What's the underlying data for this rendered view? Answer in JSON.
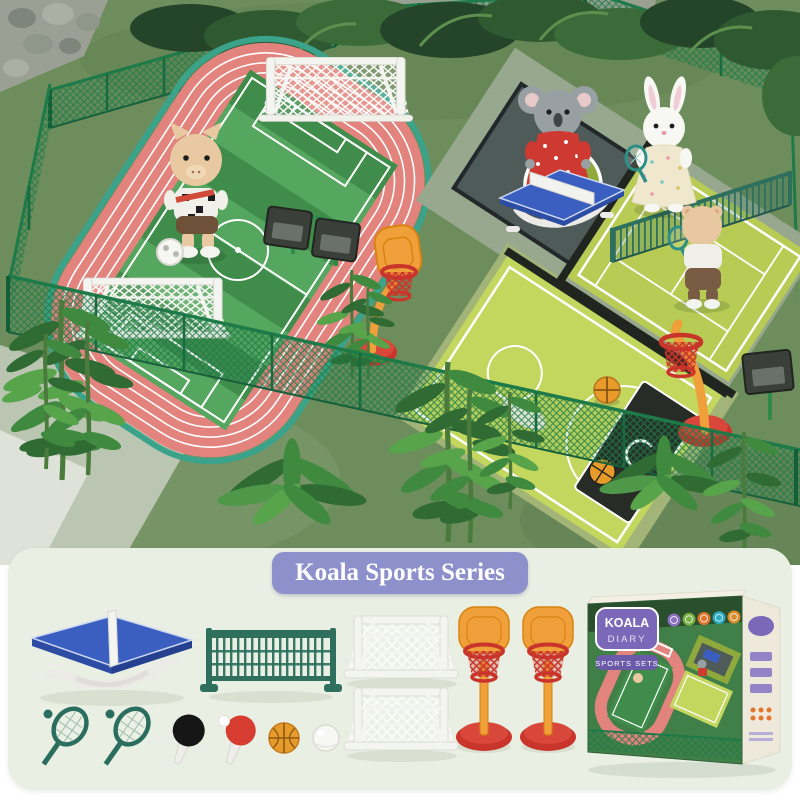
{
  "banner": {
    "title": "Koala Sports Series",
    "bg": "#8e90cb",
    "text_color": "#ffffff"
  },
  "panel": {
    "bg": "#e9efe3"
  },
  "box": {
    "logo_line1": "KOALA",
    "logo_line2": "DIARY",
    "subtitle": "SPORTS SETS",
    "logo_bg": "#7b68b8",
    "strip_bg": "#6a5aa8",
    "side_bg": "#efe9db",
    "sport_icons": [
      {
        "name": "volleyball-icon",
        "color": "#8b6fc0"
      },
      {
        "name": "tennis-ball-icon",
        "color": "#76b043"
      },
      {
        "name": "basketball-icon",
        "color": "#e0752c"
      },
      {
        "name": "shuttlecock-icon",
        "color": "#2aa9c0"
      },
      {
        "name": "soccer-ball-icon",
        "color": "#d98e2b"
      }
    ]
  },
  "items": {
    "table_tennis_table": {
      "name": "table-tennis-table",
      "top": "#3a5fc0",
      "legs": "#eceae6"
    },
    "net": {
      "name": "tennis-net",
      "color": "#2e6f5e"
    },
    "soccer_goal": {
      "name": "soccer-goal",
      "color": "#f4f4f0",
      "count": 2
    },
    "hoop_stand": {
      "name": "basketball-hoop-stand",
      "board": "#f0a03a",
      "basket": "#c9352b",
      "count": 2
    },
    "racket": {
      "name": "tennis-racket",
      "color": "#2b6e5f",
      "count": 2
    },
    "paddle_black": {
      "name": "table-tennis-paddle",
      "color": "#161616"
    },
    "paddle_red": {
      "name": "table-tennis-paddle",
      "color": "#d63c2f"
    },
    "basketball": {
      "name": "basketball",
      "color": "#e89a2b"
    },
    "white_ball": {
      "name": "ball",
      "color": "#f7f7f4"
    }
  },
  "scene": {
    "figures": {
      "pig": "pig-soccer-player",
      "koala": "koala-table-tennis-player",
      "rabbit": "rabbit-tennis-player",
      "bear": "bear-tennis-player"
    },
    "colors": {
      "grass": "#6e8d5d",
      "track": "#e2837d",
      "track_accent": "#3aa38a",
      "field_dark": "#3f8c4b",
      "field_light": "#55a65f",
      "apron": "#97a88e",
      "mat": "#4f5b58",
      "tennis": "#b7cb55",
      "basketball_court": "#c3d65e",
      "key": "#272c26",
      "fence": "#1e7a48",
      "table": "#3a5fc0",
      "hoop_orange": "#f0a03a",
      "hoop_red": "#c9352b"
    }
  }
}
